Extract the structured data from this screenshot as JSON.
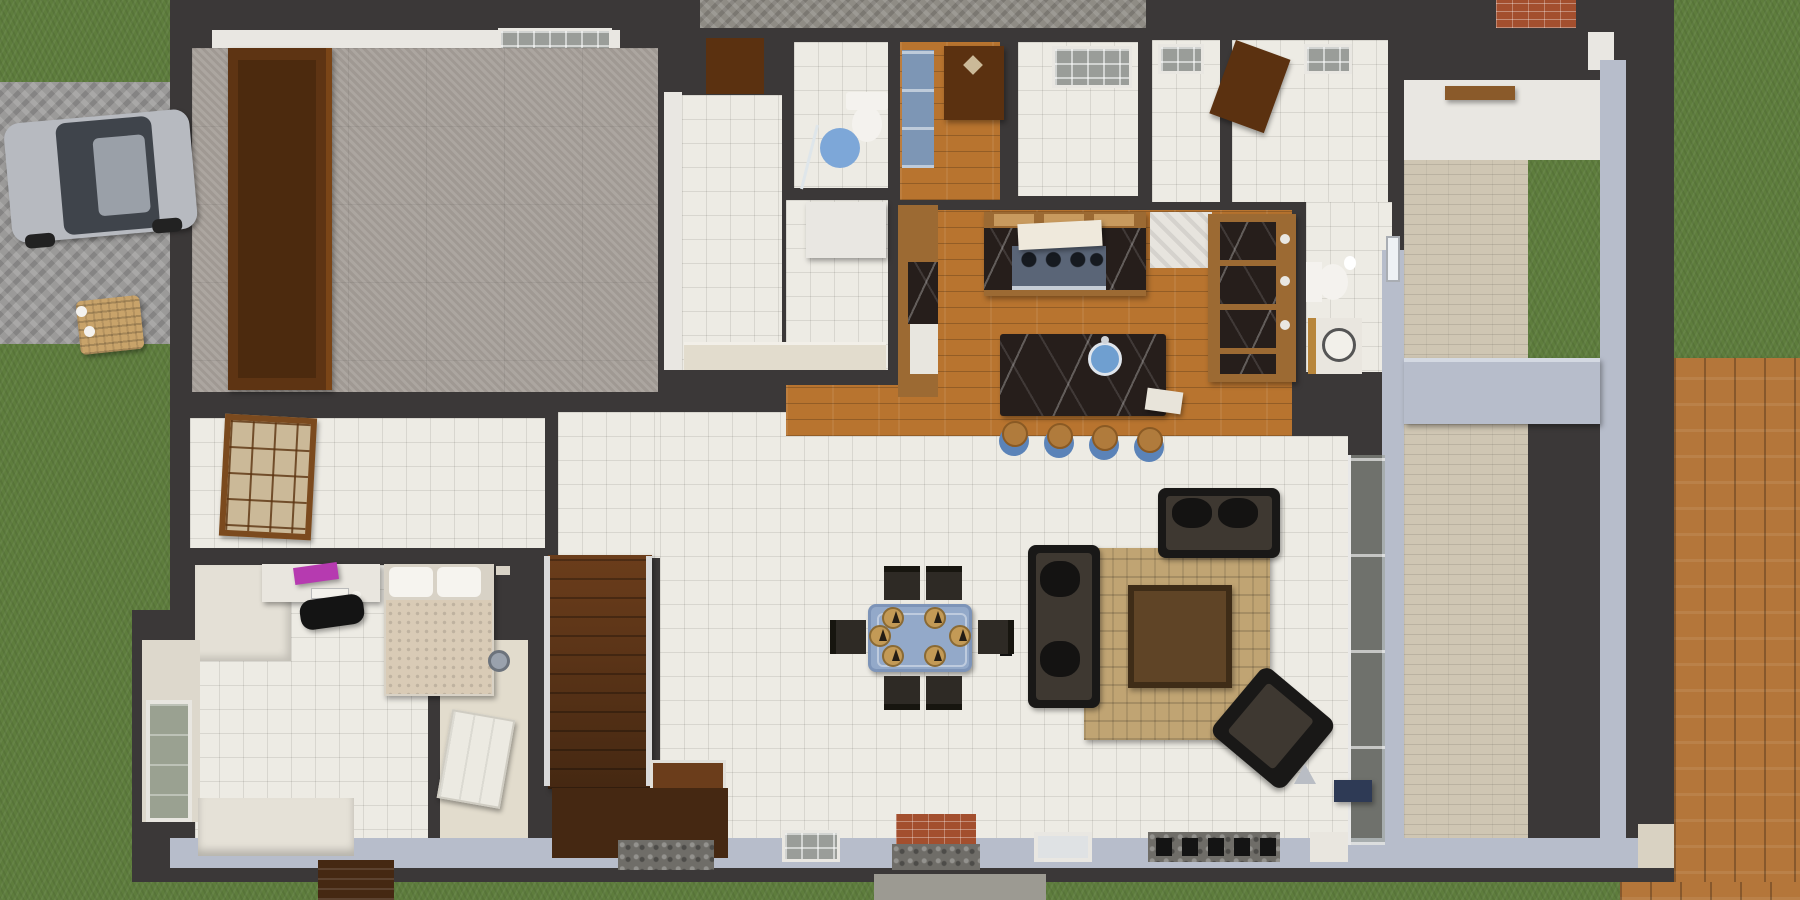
{
  "scene": {
    "title": "3D rendered top-down floor plan of a single-storey house with driveway, courtyard and rear wood deck"
  },
  "palette": {
    "grass": "#5e7d3d",
    "deck": "#b4763a",
    "paver": "#9b9a99",
    "brickPatio": "#8f8c85",
    "path": "#cfc6b3",
    "wall": "#3b3838",
    "wallFace": "#b7bdcb",
    "white": "#e9e7e2",
    "cream": "#e2dccd",
    "tile": "#edebe4",
    "carpet": "#a8a19b",
    "wood": "#b8742f",
    "counterWood": "#9c6a33",
    "marble": "#261e1b",
    "doorBrown": "#5b3110",
    "wardrobe": "#5e3413",
    "shoji": "#7b4a1e",
    "shojiGlass": "#cbb998",
    "stair": "#6b3d1b",
    "stairDark": "#452812",
    "sofa": "#191817",
    "seat": "#3e3831",
    "rug": "#c0a473",
    "tableGlass": "#93a9c9",
    "tableEdge": "#7d94b8",
    "chair": "#2e2a25",
    "plate": "#c39a56",
    "stoolBlue": "#5b83b8",
    "stoolWood": "#b07b3c",
    "sinkBlue": "#6f9fd0",
    "stove": "#5a6577",
    "blanket": "#d9cbb6",
    "laptop": "#b63ab0",
    "car": "#b7bac0",
    "carGlass": "#3f444b",
    "carRoof": "#9aa0a8",
    "brick": "#a34f2e",
    "cobble": "#6f6d68",
    "glass": "#9a9d99",
    "beamWood": "#8a5a2a",
    "navy": "#2e3a55",
    "matBlue": "#7da7d8",
    "mirrorCab": "#7d96b5"
  },
  "labels": {
    "car": "Parked silver car on paver driveway",
    "wardrobe": "Bedroom wardrobe",
    "dining_table": "Glass dining table with six chairs",
    "sofa": "Three-seat black sofa",
    "loveseat": "Black loveseat",
    "armchair": "Black armchair",
    "coffee_table": "Brown coffee table on rug",
    "island": "Kitchen island with round sink",
    "stove": "Cooktop with pots",
    "stool": "Kitchen bar stool",
    "stairs": "Wooden staircase",
    "bed": "Single bed with two pillows",
    "desk": "Desk with laptop",
    "toilet": "Toilet",
    "shower": "Shower area",
    "deck": "Rear wood deck",
    "fireplace": "Brick fireplace in rear wall"
  }
}
